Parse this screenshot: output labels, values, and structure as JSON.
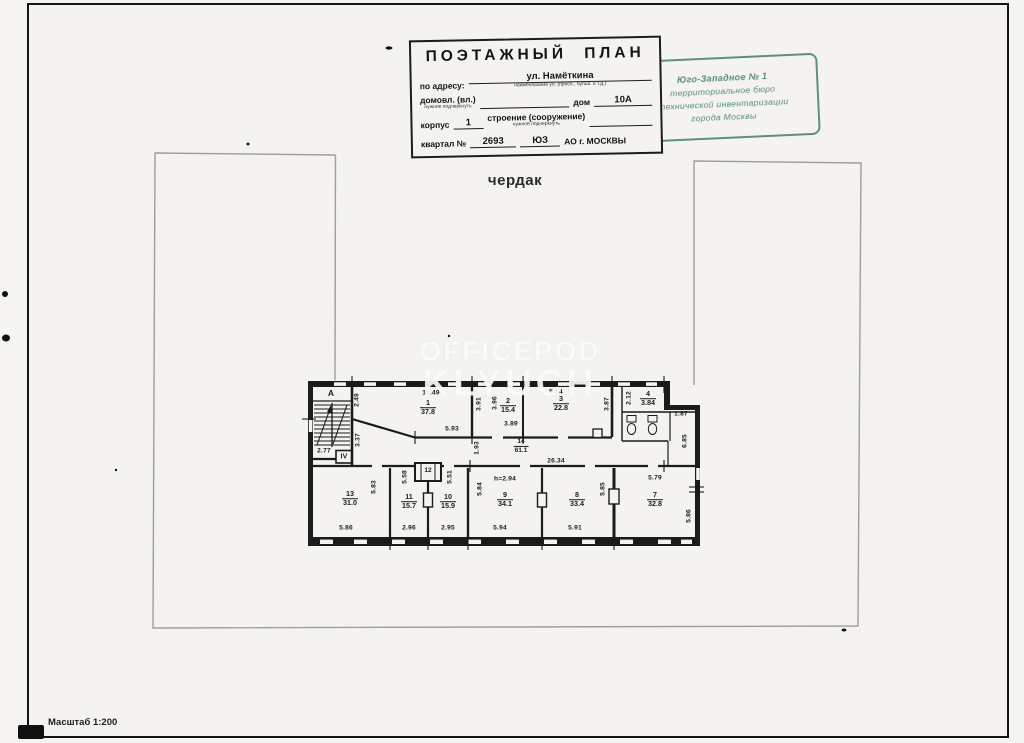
{
  "page": {
    "floor_label": "чердак",
    "scale_label": "Масштаб 1:200"
  },
  "title_block": {
    "title": "ПОЭТАЖНЫЙ ПЛАН",
    "address_label": "по адресу:",
    "address_value": "ул. Намёткина",
    "address_caption": "наименование ул. (просп., бульв. и т.д.)",
    "ownership_label": "домовл. (вл.)",
    "ownership_caption": "нужное подчеркнуть",
    "house_label": "дом",
    "house_value": "10А",
    "korpus_label": "корпус",
    "korpus_value": "1",
    "stroenie_label": "строение (сооружение)",
    "stroenie_caption": "нужное подчеркнуть",
    "kvartal_label": "квартал №",
    "kvartal_value": "2693",
    "okrug_value": "ЮЗ",
    "city_value": "АО г. МОСКВЫ"
  },
  "stamp": {
    "badge": "З",
    "ink_color": "#40806a",
    "lines": [
      "Юго-Западное № 1",
      "территориальное бюро",
      "технической инвентаризации",
      "города Москвы"
    ]
  },
  "watermark": {
    "line1": "OFFICEPOD",
    "line2": "KLYUCH"
  },
  "plan": {
    "stair": {
      "letter": "А",
      "width": "2.77",
      "section": "IV"
    },
    "rooms": {
      "r1": {
        "n": "1",
        "a": "37.8"
      },
      "r2": {
        "n": "2",
        "a": "15.4"
      },
      "r3": {
        "n": "3",
        "a": "22.8"
      },
      "r4": {
        "n": "4",
        "a": "3.84"
      },
      "r7": {
        "n": "7",
        "a": "32.8"
      },
      "r8": {
        "n": "8",
        "a": "33.4"
      },
      "r9": {
        "n": "9",
        "a": "34.1"
      },
      "r10": {
        "n": "10",
        "a": "15.9"
      },
      "r11": {
        "n": "11",
        "a": "15.7"
      },
      "r12": {
        "n": "12"
      },
      "r13": {
        "n": "13",
        "a": "31.0"
      },
      "r14": {
        "n": "14",
        "a": "61.1"
      }
    },
    "dims": {
      "r1_left_upper": "2.49",
      "r1_top": "10.49",
      "r1_left_lower": "3.37",
      "r1_bottom": "5.93",
      "r1_right": "3.91",
      "r2_left": "3.96",
      "r2_bottom": "3.89",
      "r3_top": "5.94",
      "r3_right": "3.87",
      "r4_left": "2.12",
      "r4_right": "1.87",
      "right_wall_upper": "6.85",
      "right_wall_lower": "5.86",
      "corr_width": "1.93",
      "corr_length": "26.34",
      "r13_depth": "5.83",
      "r13_bottom": "5.86",
      "r11_depth": "5.58",
      "r11_bottom": "2.96",
      "r10_depth": "5.51",
      "r10_bottom": "2.95",
      "r9_left": "5.84",
      "r9_bottom": "5.94",
      "r9_height": "h=2.94",
      "r8_bottom": "5.91",
      "r8_right": "5.85",
      "r7_top": "5.79"
    }
  }
}
